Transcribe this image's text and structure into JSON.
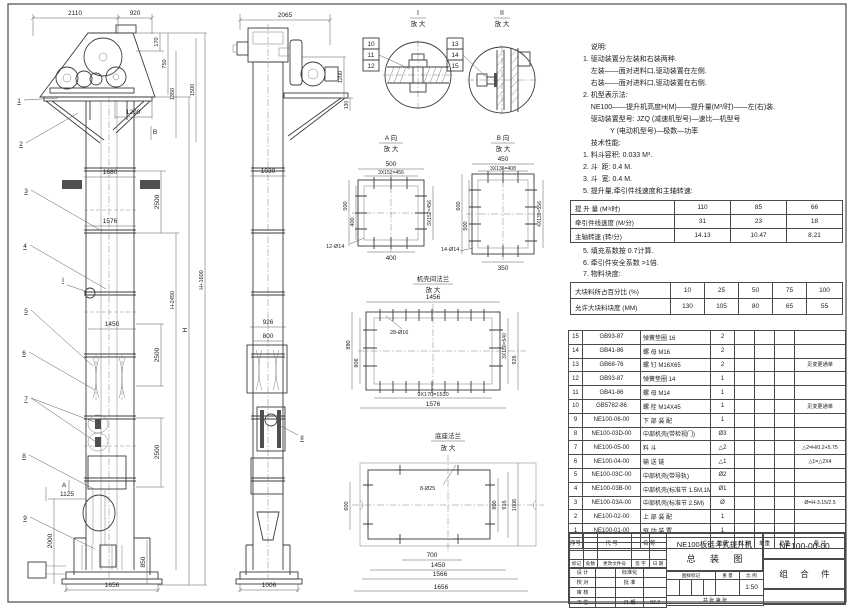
{
  "notes": {
    "lines": [
      "    说明:",
      "1. 驱动装置分左装和右装两种.",
      "    左装——面对进料口,驱动装置在左侧.",
      "    右装——面对进料口,驱动装置在右侧.",
      "2. 机型表示法:",
      "    NE100——提升机高度H(M)——提升量(M³/时)——左(右)装.",
      "    驱动装置型号: JZQ (减速机型号)—速比—机型号",
      "              Y (电动机型号)—极数—功率",
      "    技术性能:",
      "1. 料斗容积: 0.033 M³.",
      "2. 斗  距: 0.4 M.",
      "3. 斗  宽: 0.4 M.",
      "5. 提升量,牵引件线速度和主轴转速:"
    ]
  },
  "lift_table": {
    "rows": [
      [
        "提 升 量 (M³/时)",
        "110",
        "85",
        "66"
      ],
      [
        "牵引件线速度 (M/分)",
        "31",
        "23",
        "18"
      ],
      [
        "主轴转速 (转/分)",
        "14.13",
        "10.47",
        "8.21"
      ]
    ]
  },
  "notes2": {
    "lines": [
      "5. 填充系数按 0.7计算.",
      "6. 牵引件安全系数 >1倍.",
      "7. 物料块度:"
    ]
  },
  "lump_table": {
    "rows": [
      [
        "大块料所占百分比 (%)",
        "10",
        "25",
        "50",
        "75",
        "100"
      ],
      [
        "允许大块料块度 (MM)",
        "130",
        "105",
        "80",
        "65",
        "55"
      ]
    ]
  },
  "bom": {
    "headers": [
      "序号",
      "代 号",
      "名 称",
      "数量",
      "材 料",
      "单重",
      "总重",
      "备 注"
    ],
    "rows": [
      [
        "15",
        "GB93-87",
        "弹簧垫圈 16",
        "2",
        "",
        "",
        "",
        ""
      ],
      [
        "14",
        "GB41-86",
        "螺 母 M16",
        "2",
        "",
        "",
        "",
        ""
      ],
      [
        "13",
        "GB68-76",
        "螺 钉 M16X65",
        "2",
        "",
        "",
        "",
        "见变更通单"
      ],
      [
        "12",
        "GB93-87",
        "弹簧垫圈 14",
        "1",
        "",
        "",
        "",
        ""
      ],
      [
        "11",
        "GB41-86",
        "螺 母 M14",
        "1",
        "",
        "",
        "",
        ""
      ],
      [
        "10",
        "GB5782-86",
        "螺 栓 M14X45",
        "1",
        "",
        "",
        "",
        "见变更通单"
      ],
      [
        "9",
        "NE100-06-00",
        "下 部 装 配",
        "1",
        "",
        "",
        "",
        ""
      ],
      [
        "8",
        "NE100-03D-00",
        "中部机壳(带检视门)",
        "Ø3",
        "",
        "",
        "",
        ""
      ],
      [
        "7",
        "NE100-05-00",
        "料 斗",
        "△2",
        "",
        "",
        "",
        "△2=H/0.2+5.75"
      ],
      [
        "6",
        "NE100-04-00",
        "输 送 链",
        "△1",
        "",
        "",
        "",
        "△1=△2X4"
      ],
      [
        "5",
        "NE100-03C-00",
        "中部机壳(带导轨)",
        "Ø2",
        "",
        "",
        "",
        ""
      ],
      [
        "4",
        "NE100-03B-00",
        "中部机壳(标准节 1.5M,1M)",
        "Ø1",
        "",
        "",
        "",
        ""
      ],
      [
        "3",
        "NE100-03A-00",
        "中部机壳(标准节 2.5M)",
        "Ø",
        "",
        "",
        "",
        "Ø=H-3.15/2.5"
      ],
      [
        "2",
        "NE100-02-00",
        "上 部 装 配",
        "1",
        "",
        "",
        "",
        ""
      ],
      [
        "1",
        "NE100-01-00",
        "驱 动 装 置",
        "1",
        "",
        "",
        "",
        ""
      ]
    ]
  },
  "titleblock": {
    "drawing_title_1": "NE100板链斗式提升机",
    "drawing_title_2": "总 装 图",
    "drawing_no": "NE100-00-00",
    "part_type": "组 合 件",
    "rev_headers": [
      "标记",
      "处数",
      "更改文件号",
      "签 字",
      "日 期"
    ],
    "roles": {
      "design": "设 计",
      "check": "校 对",
      "review": "审 核",
      "process": "工 艺",
      "standard": "标准化",
      "approve": "批 准",
      "date_label": "日 期",
      "date_value": "97.7"
    },
    "stamp_headers": [
      "图样标记",
      "重 量",
      "比 例"
    ],
    "scale": "1:50",
    "sheet_label": "共  张  第  张"
  },
  "front": {
    "leaders": {
      "1": "1",
      "2": "2",
      "3": "3",
      "4": "4",
      "5": "5",
      "6": "6",
      "7": "7",
      "8": "8",
      "9": "9"
    },
    "markers": {
      "a": "A",
      "b": "B",
      "i": "I"
    },
    "dims": {
      "2110": "2110",
      "920": "920",
      "170": "170",
      "750": "750",
      "1350": "1350",
      "1500": "1500",
      "1200": "1200",
      "1680": "1680",
      "2500": "2500",
      "1576": "1576",
      "h2450": "H-2450",
      "h": "H",
      "h1600": "H+1600",
      "1450": "1450",
      "1125": "1125",
      "2000": "2000",
      "850": "850",
      "1656": "1656"
    }
  },
  "side": {
    "marker": "II",
    "dims": {
      "2065": "2065",
      "1200": "1200",
      "130": "130",
      "1030": "1030",
      "926": "926",
      "800": "800",
      "1006": "1006"
    }
  },
  "detail_i": {
    "title": "I",
    "sub": "放 大",
    "tags": [
      "10",
      "11",
      "12"
    ]
  },
  "detail_ii": {
    "title": "II",
    "sub": "放 大",
    "tags": [
      "13",
      "14",
      "15"
    ]
  },
  "detail_a": {
    "title": "A 向",
    "sub": "放 大",
    "dims": {
      "500": "500",
      "456": "3X152=456",
      "400": "400",
      "400b": "400",
      "holes": "12-Ø14"
    }
  },
  "detail_b": {
    "title": "B 向",
    "sub": "放 大",
    "dims": {
      "450": "450",
      "408": "3X136=408",
      "600": "600",
      "500": "500",
      "556": "4X139=556",
      "350": "350",
      "holes": "14-Ø14"
    }
  },
  "detail_flange": {
    "title": "机壳间法兰",
    "sub": "放 大",
    "dims": {
      "1456": "1456",
      "holes": "28-Ø16",
      "880": "880",
      "806": "806",
      "540": "3X180=540",
      "926": "926",
      "1530": "9X170=1530",
      "1576": "1576"
    }
  },
  "detail_base": {
    "title": "底座法兰",
    "sub": "放 大",
    "dims": {
      "holes": "8-Ø25",
      "600": "600",
      "800": "800",
      "916": "916",
      "1006": "1006",
      "700": "700",
      "1450": "1450",
      "1566": "1566",
      "1656": "1656"
    }
  }
}
